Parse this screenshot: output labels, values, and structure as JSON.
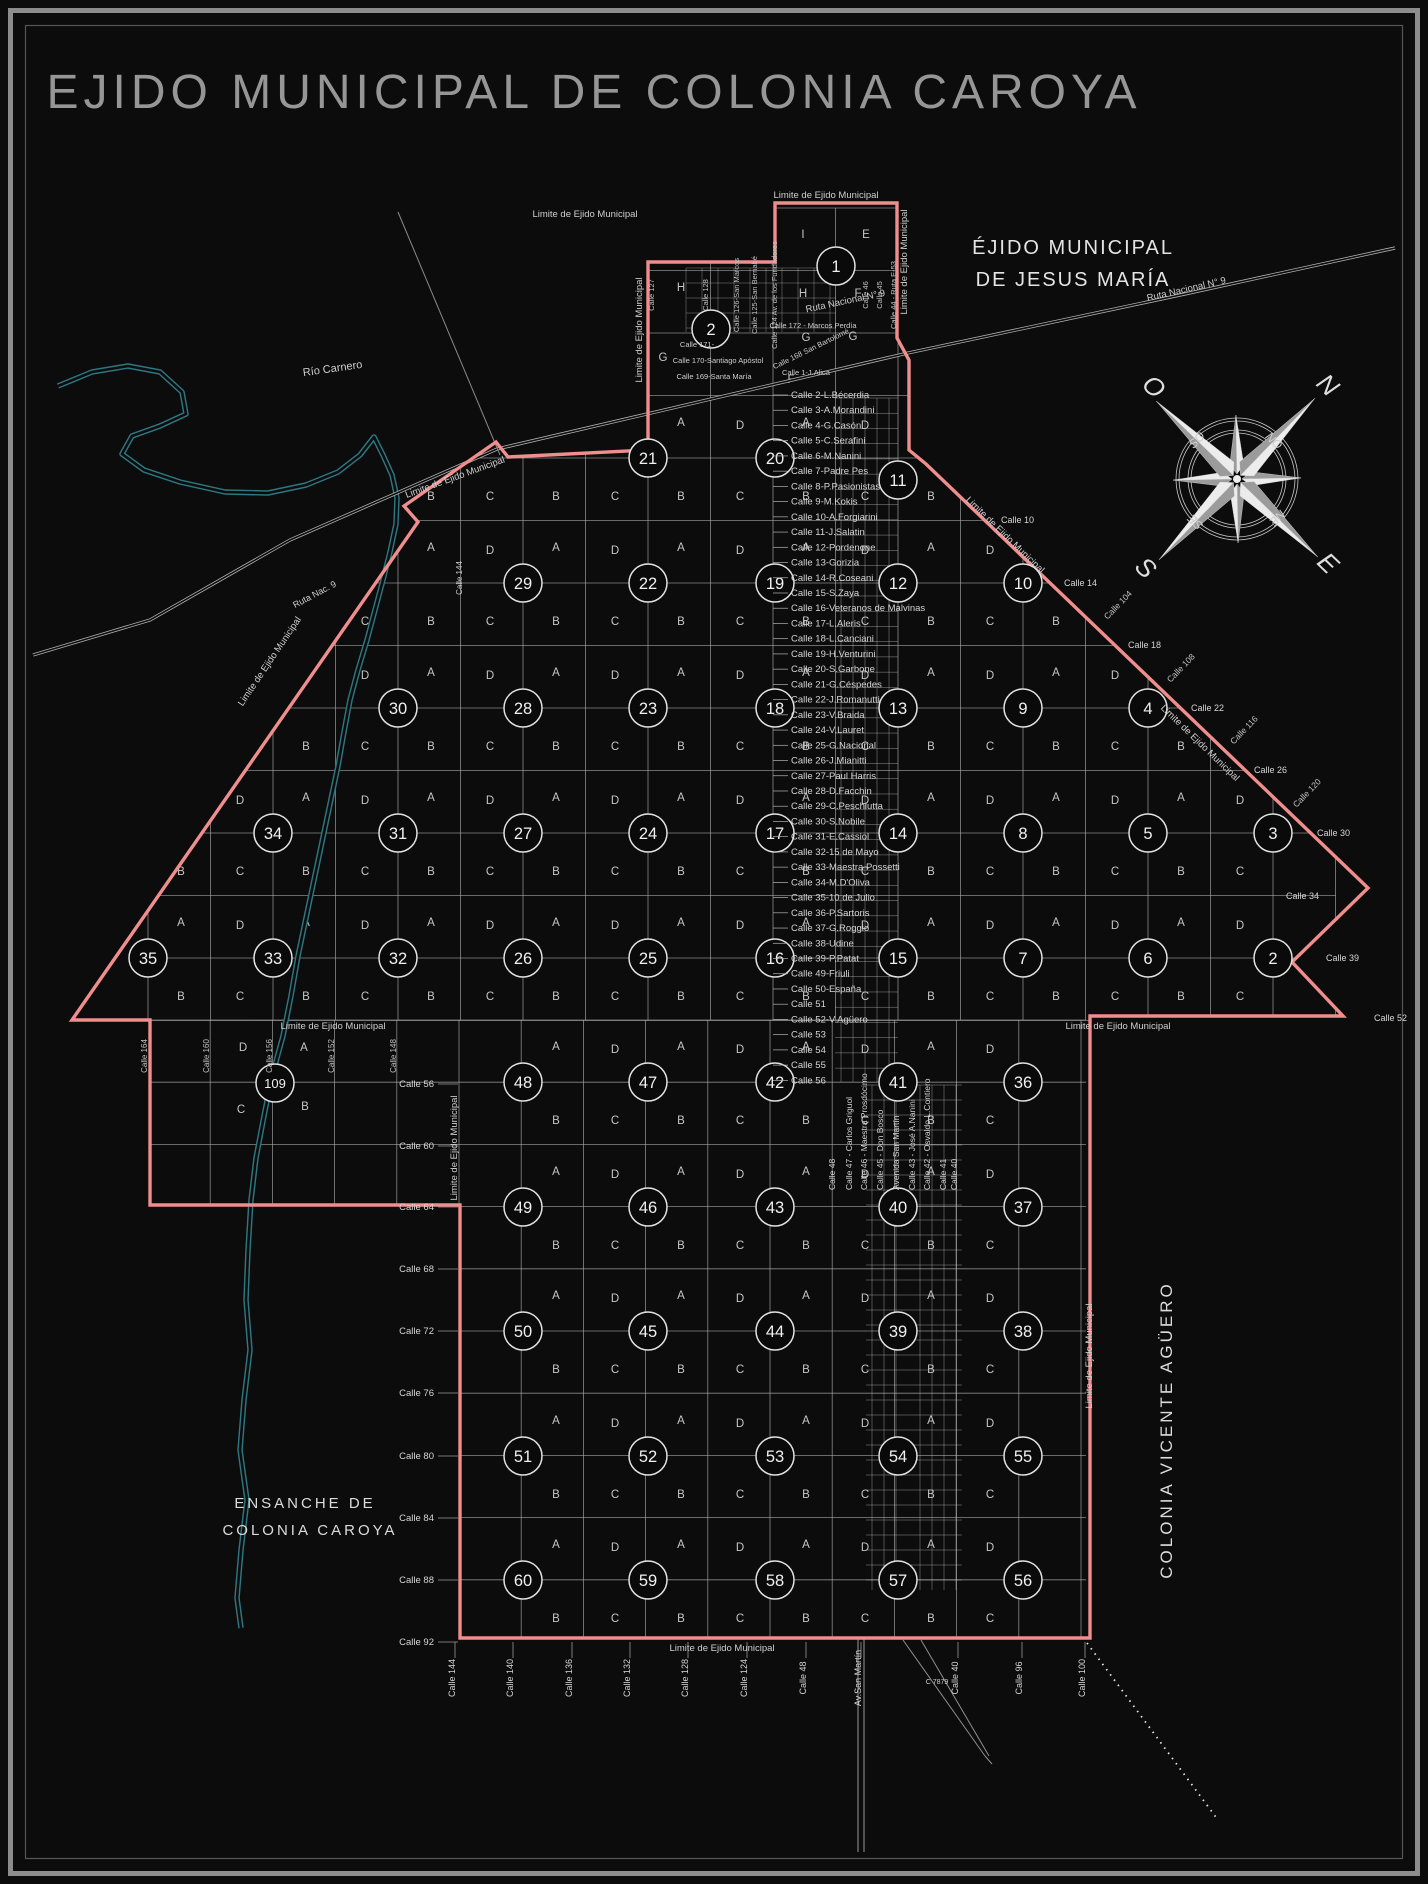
{
  "title": "EJIDO MUNICIPAL DE COLONIA CAROYA",
  "colors": {
    "background": "#0c0c0c",
    "boundary_pink": "#f08d8d",
    "grid_gray": "#a9a9a9",
    "dense_gray": "#c9c9c9",
    "river_teal": "#2e7680",
    "label_light": "#d6d6d6",
    "label_dim": "#9e9e9e",
    "circle_stroke": "#e2e2e2",
    "frame_gray": "#8c8c8c"
  },
  "boundary": {
    "label": "Limite de Ejido Municipal",
    "points": "775,203 897,203 897,338 909,360 909,450 926,464 1368,888 1292,962 1343,1016 1090,1016 1090,1638 460,1638 460,1205 150,1205 150,1020 72,1020 418,522 404,506 496,442 508,457 648,450 648,262 775,262"
  },
  "river": {
    "label": "Río Carnero",
    "points": "58,386 92,372 128,366 160,372 182,392 186,414 160,426 132,436 122,454 144,470 180,482 225,492 268,493 306,485 338,472 360,455 374,437 383,455 392,475 397,498 396,524 390,552 383,580 375,610 367,640 358,670 350,700 344,732 338,766 330,804 322,842 314,880 306,918 298,956 291,996 283,1036 272,1076 264,1116 256,1158 251,1200 248,1250 246,1300 250,1350 244,1400 240,1450 247,1500 241,1550 237,1598 241,1628"
  },
  "roads": {
    "ruta9_points": "33,655 150,620 290,540 497,449 908,353 1185,294 1395,248",
    "crossroad": [
      398,
      212,
      500,
      455
    ],
    "avenue_extension": {
      "x1": 858,
      "x2": 864,
      "y0": 1638,
      "y1": 1852
    },
    "wedge": [
      [
        903,
        1640,
        985,
        1756
      ],
      [
        921,
        1640,
        989,
        1756
      ],
      [
        985,
        1756,
        992,
        1764
      ]
    ],
    "dotted_rail": [
      1087,
      1643,
      1218,
      1820
    ]
  },
  "grid": {
    "upper": {
      "x0": 148,
      "x1": 1336,
      "y0": 208,
      "y1": 1020,
      "step": 62.5
    },
    "lower": {
      "x0": 148,
      "x1": 1086,
      "y0": 1020,
      "y1": 1641,
      "step": 62.2
    },
    "dense_top": {
      "x0": 686,
      "x1": 836,
      "y0": 268,
      "y1": 332,
      "col_step": 16,
      "row_step": 15
    },
    "dense_upper": {
      "cols": [
        841,
        853,
        865,
        877,
        889
      ],
      "x0": 835,
      "x1": 898,
      "y0": 398,
      "y1": 1082,
      "row_step": 15.23
    },
    "dense_lower": {
      "cols": [
        872,
        884,
        896,
        920,
        932,
        944,
        956
      ],
      "x0": 866,
      "x1": 962,
      "y0": 1085,
      "y1": 1590,
      "row_step": 15
    }
  },
  "blocks": {
    "circles": [
      {
        "n": "1",
        "x": 836,
        "y": 266
      },
      {
        "n": "2",
        "x": 711,
        "y": 329
      },
      {
        "n": "11",
        "x": 898,
        "y": 480
      },
      {
        "n": "21",
        "x": 648,
        "y": 458
      },
      {
        "n": "20",
        "x": 775,
        "y": 458
      },
      {
        "n": "29",
        "x": 523,
        "y": 583
      },
      {
        "n": "22",
        "x": 648,
        "y": 583
      },
      {
        "n": "19",
        "x": 775,
        "y": 583
      },
      {
        "n": "12",
        "x": 898,
        "y": 583
      },
      {
        "n": "10",
        "x": 1023,
        "y": 583
      },
      {
        "n": "30",
        "x": 398,
        "y": 708
      },
      {
        "n": "28",
        "x": 523,
        "y": 708
      },
      {
        "n": "23",
        "x": 648,
        "y": 708
      },
      {
        "n": "18",
        "x": 775,
        "y": 708
      },
      {
        "n": "13",
        "x": 898,
        "y": 708
      },
      {
        "n": "9",
        "x": 1023,
        "y": 708
      },
      {
        "n": "4",
        "x": 1148,
        "y": 708
      },
      {
        "n": "34",
        "x": 273,
        "y": 833
      },
      {
        "n": "31",
        "x": 398,
        "y": 833
      },
      {
        "n": "27",
        "x": 523,
        "y": 833
      },
      {
        "n": "24",
        "x": 648,
        "y": 833
      },
      {
        "n": "17",
        "x": 775,
        "y": 833
      },
      {
        "n": "14",
        "x": 898,
        "y": 833
      },
      {
        "n": "8",
        "x": 1023,
        "y": 833
      },
      {
        "n": "5",
        "x": 1148,
        "y": 833
      },
      {
        "n": "3",
        "x": 1273,
        "y": 833
      },
      {
        "n": "35",
        "x": 148,
        "y": 958
      },
      {
        "n": "33",
        "x": 273,
        "y": 958
      },
      {
        "n": "32",
        "x": 398,
        "y": 958
      },
      {
        "n": "26",
        "x": 523,
        "y": 958
      },
      {
        "n": "25",
        "x": 648,
        "y": 958
      },
      {
        "n": "16",
        "x": 775,
        "y": 958
      },
      {
        "n": "15",
        "x": 898,
        "y": 958
      },
      {
        "n": "7",
        "x": 1023,
        "y": 958
      },
      {
        "n": "6",
        "x": 1148,
        "y": 958
      },
      {
        "n": "2",
        "x": 1273,
        "y": 958
      },
      {
        "n": "109",
        "x": 275,
        "y": 1083
      },
      {
        "n": "48",
        "x": 523,
        "y": 1082
      },
      {
        "n": "47",
        "x": 648,
        "y": 1082
      },
      {
        "n": "42",
        "x": 775,
        "y": 1082
      },
      {
        "n": "41",
        "x": 898,
        "y": 1082
      },
      {
        "n": "36",
        "x": 1023,
        "y": 1082
      },
      {
        "n": "49",
        "x": 523,
        "y": 1207
      },
      {
        "n": "46",
        "x": 648,
        "y": 1207
      },
      {
        "n": "43",
        "x": 775,
        "y": 1207
      },
      {
        "n": "40",
        "x": 898,
        "y": 1207
      },
      {
        "n": "37",
        "x": 1023,
        "y": 1207
      },
      {
        "n": "50",
        "x": 523,
        "y": 1331
      },
      {
        "n": "45",
        "x": 648,
        "y": 1331
      },
      {
        "n": "44",
        "x": 775,
        "y": 1331
      },
      {
        "n": "39",
        "x": 898,
        "y": 1331
      },
      {
        "n": "38",
        "x": 1023,
        "y": 1331
      },
      {
        "n": "51",
        "x": 523,
        "y": 1456
      },
      {
        "n": "52",
        "x": 648,
        "y": 1456
      },
      {
        "n": "53",
        "x": 775,
        "y": 1456
      },
      {
        "n": "54",
        "x": 898,
        "y": 1456
      },
      {
        "n": "55",
        "x": 1023,
        "y": 1456
      },
      {
        "n": "60",
        "x": 523,
        "y": 1580
      },
      {
        "n": "59",
        "x": 648,
        "y": 1580
      },
      {
        "n": "58",
        "x": 775,
        "y": 1580
      },
      {
        "n": "57",
        "x": 898,
        "y": 1580
      },
      {
        "n": "56",
        "x": 1023,
        "y": 1580
      }
    ]
  },
  "quadrants": {
    "letters": [
      "A",
      "D",
      "B",
      "C"
    ],
    "upper": {
      "cols": [
        148,
        273,
        398,
        523,
        648,
        773,
        898,
        1023,
        1148,
        1273
      ],
      "rows": [
        458,
        583,
        708,
        833,
        958
      ]
    },
    "lower": {
      "cols": [
        523,
        648,
        773,
        898,
        1023
      ],
      "rows": [
        1082,
        1207,
        1331,
        1456,
        1580
      ]
    },
    "extra": [
      {
        "t": "D",
        "x": 243,
        "y": 1051
      },
      {
        "t": "A",
        "x": 304,
        "y": 1051
      },
      {
        "t": "C",
        "x": 241,
        "y": 1113
      },
      {
        "t": "B",
        "x": 305,
        "y": 1110
      },
      {
        "t": "I",
        "x": 803,
        "y": 238
      },
      {
        "t": "E",
        "x": 866,
        "y": 238
      },
      {
        "t": "H",
        "x": 681,
        "y": 291
      },
      {
        "t": "H",
        "x": 803,
        "y": 297
      },
      {
        "t": "F",
        "x": 858,
        "y": 297
      },
      {
        "t": "F",
        "x": 791,
        "y": 383
      },
      {
        "t": "G",
        "x": 663,
        "y": 361
      },
      {
        "t": "G",
        "x": 806,
        "y": 341
      },
      {
        "t": "G",
        "x": 853,
        "y": 340
      }
    ]
  },
  "center_streets": {
    "x": 791,
    "y_start": 398,
    "spacing": 15.23,
    "items": [
      "Calle 2-L.Bécerdia",
      "Calle 3-A.Morandini",
      "Calle 4-G.Casón",
      "Calle 5-C.Serafini",
      "Calle 6-M.Nanini",
      "Calle 7-Padre Pes",
      "Calle 8-P.Pasionistas",
      "Calle 9-M.Kokis",
      "Calle 10-A.Forgiarini",
      "Calle 11-J.Salatin",
      "Calle 12-Pordenone",
      "Calle 13-Gorizia",
      "Calle 14-R.Coseani",
      "Calle 15-S.Zaya",
      "Calle 16-Veteranos de Malvinas",
      "Calle 17-L.Aleris",
      "Calle 18-L.Canciani",
      "Calle 19-H.Venturini",
      "Calle 20-S.Garbone",
      "Calle 21-G.Céspedes",
      "Calle 22-J.Romanutti",
      "Calle 23-V.Braida",
      "Calle 24-V.Lauret",
      "Calle 25-G.Nacional",
      "Calle 26-J.Mianitti",
      "Calle 27-Paul Harris",
      "Calle 28-D.Facchin",
      "Calle 29-C.Peschiutta",
      "Calle 30-S.Nobile",
      "Calle 31-E.Cassiol",
      "Calle 32-15 de Mayo",
      "Calle 33-Maestra Possetti",
      "Calle 34-M.D'Oliva",
      "Calle 35-10 de Julio",
      "Calle 36-P.Sartoris",
      "Calle 37-G.Roggio",
      "Calle 38-Udine",
      "Calle 39-P.Patat",
      "Calle 49-Friuli",
      "Calle 50-España",
      "Calle 51",
      "Calle 52-V.Agüero",
      "Calle 53",
      "Calle 54",
      "Calle 55",
      "Calle 56"
    ]
  },
  "bottom_center_streets": {
    "y": 1190,
    "items": [
      {
        "x": 835,
        "t": "Calle 48"
      },
      {
        "x": 852,
        "t": "Calle 47 - Carlos Griguol"
      },
      {
        "x": 867,
        "t": "Calle 46 - Maestra Prosdócimo"
      },
      {
        "x": 883,
        "t": "Calle 45 - Don Bosco"
      },
      {
        "x": 899,
        "t": "Avenida San Martín"
      },
      {
        "x": 915,
        "t": "Calle 43 - José A.Nanini"
      },
      {
        "x": 930,
        "t": "Calle 42 - Osvaldo L.Contiero"
      },
      {
        "x": 946,
        "t": "Calle 41"
      },
      {
        "x": 957,
        "t": "Calle 40"
      }
    ]
  },
  "left_margin": {
    "x": 434,
    "items": [
      {
        "y": 1084,
        "t": "Calle 56"
      },
      {
        "y": 1146,
        "t": "Calle 60"
      },
      {
        "y": 1207,
        "t": "Calle 64"
      },
      {
        "y": 1269,
        "t": "Calle 68"
      },
      {
        "y": 1331,
        "t": "Calle 72"
      },
      {
        "y": 1393,
        "t": "Calle 76"
      },
      {
        "y": 1456,
        "t": "Calle 80"
      },
      {
        "y": 1518,
        "t": "Calle 84"
      },
      {
        "y": 1580,
        "t": "Calle 88"
      },
      {
        "y": 1642,
        "t": "Calle 92"
      }
    ]
  },
  "bottom_streets": {
    "y": 1678,
    "items": [
      {
        "x": 455,
        "t": "Calle 144"
      },
      {
        "x": 513,
        "t": "Calle 140"
      },
      {
        "x": 572,
        "t": "Calle 136"
      },
      {
        "x": 630,
        "t": "Calle 132"
      },
      {
        "x": 688,
        "t": "Calle 128"
      },
      {
        "x": 747,
        "t": "Calle 124"
      },
      {
        "x": 806,
        "t": "Calle 48"
      },
      {
        "x": 861,
        "t": "Av.San Martín"
      },
      {
        "x": 958,
        "t": "Calle 40"
      },
      {
        "x": 1022,
        "t": "Calle 96"
      },
      {
        "x": 1085,
        "t": "Calle 100"
      }
    ]
  },
  "left_extension_streets": {
    "y": 1056,
    "items": [
      {
        "x": 147,
        "t": "Calle 164"
      },
      {
        "x": 209,
        "t": "Calle 160"
      },
      {
        "x": 272,
        "t": "Calle 156"
      },
      {
        "x": 334,
        "t": "Calle 152"
      },
      {
        "x": 396,
        "t": "Calle 148"
      }
    ]
  },
  "right_edge_labels": {
    "horizontal": [
      {
        "x": 1001,
        "y": 523,
        "t": "Calle 10"
      },
      {
        "x": 1064,
        "y": 586,
        "t": "Calle 14"
      },
      {
        "x": 1128,
        "y": 648,
        "t": "Calle 18"
      },
      {
        "x": 1191,
        "y": 711,
        "t": "Calle 22"
      },
      {
        "x": 1254,
        "y": 773,
        "t": "Calle 26"
      },
      {
        "x": 1317,
        "y": 836,
        "t": "Calle 30"
      },
      {
        "x": 1286,
        "y": 899,
        "t": "Calle 34"
      },
      {
        "x": 1326,
        "y": 961,
        "t": "Calle 39"
      },
      {
        "x": 1374,
        "y": 1021,
        "t": "Calle 52"
      }
    ],
    "rotated": [
      {
        "x": 1120,
        "y": 607,
        "t": "Calle 104"
      },
      {
        "x": 1183,
        "y": 670,
        "t": "Calle 108"
      },
      {
        "x": 1246,
        "y": 732,
        "t": "Calle 116"
      },
      {
        "x": 1309,
        "y": 795,
        "t": "Calle 120"
      }
    ]
  },
  "top_vertical_streets": {
    "y": 295,
    "items": [
      {
        "x": 654,
        "t": "Calle 127"
      },
      {
        "x": 708,
        "t": "Calle 128"
      },
      {
        "x": 739,
        "t": "Calle 126-San Marcos"
      },
      {
        "x": 757,
        "t": "Calle 125-San Bernabé"
      },
      {
        "x": 777,
        "t": "Calle 124 Av. de los Fundadores"
      },
      {
        "x": 868,
        "t": "Calle 46"
      },
      {
        "x": 882,
        "t": "Calle 45"
      },
      {
        "x": 896,
        "t": "Calle 44 - Ruta E-53"
      }
    ]
  },
  "misc_labels": [
    {
      "t": "Limite de Ejido Municipal",
      "x": 826,
      "y": 198
    },
    {
      "t": "Limite de Ejido Municipal",
      "x": 585,
      "y": 217
    },
    {
      "t": "Limite de Ejido Municipal",
      "x": 907,
      "y": 262,
      "r": -90
    },
    {
      "t": "Limite de Ejido Municipal",
      "x": 642,
      "y": 330,
      "r": -90
    },
    {
      "t": "Limite de Ejido Municipal",
      "x": 456,
      "y": 480,
      "r": -20
    },
    {
      "t": "Limite de Ejido Municipal",
      "x": 272,
      "y": 663,
      "r": -56
    },
    {
      "t": "Limite de Ejido Municipal",
      "x": 1003,
      "y": 537,
      "r": 44
    },
    {
      "t": "Limite de Ejido Municipal",
      "x": 1198,
      "y": 745,
      "r": 44
    },
    {
      "t": "Limite de Ejido Municipal",
      "x": 333,
      "y": 1029
    },
    {
      "t": "Limite de Ejido Municipal",
      "x": 1118,
      "y": 1029
    },
    {
      "t": "Limite de Ejido Municipal",
      "x": 722,
      "y": 1651
    },
    {
      "t": "Limite de Ejido Municipal",
      "x": 1092,
      "y": 1356,
      "r": -90
    },
    {
      "t": "Limite de Ejido Municipal",
      "x": 457,
      "y": 1148,
      "r": -90
    },
    {
      "t": "Río Carnero",
      "x": 333,
      "y": 372,
      "r": -8,
      "s": 11
    },
    {
      "t": "Ruta Nacional N° 9",
      "x": 846,
      "y": 304,
      "r": -12
    },
    {
      "t": "Ruta Nacional N° 9",
      "x": 1187,
      "y": 292,
      "r": -13
    },
    {
      "t": "Ruta Nac. 9",
      "x": 316,
      "y": 597,
      "r": -28,
      "s": 9
    },
    {
      "t": "Calle 168 San Bartolomé",
      "x": 812,
      "y": 351,
      "r": -26,
      "s": 7.5
    },
    {
      "t": "Calle 172 - Marcos Perdía",
      "x": 813,
      "y": 328,
      "s": 7.5
    },
    {
      "t": "Calle 171-",
      "x": 697,
      "y": 347,
      "s": 7.5
    },
    {
      "t": "Calle 170-Santiago Apóstol",
      "x": 718,
      "y": 363,
      "s": 7.5
    },
    {
      "t": "Calle 169-Santa María",
      "x": 714,
      "y": 379,
      "s": 7.5
    },
    {
      "t": "Calle 1-J.Alica",
      "x": 806,
      "y": 375,
      "s": 7.5
    },
    {
      "t": "Calle 144",
      "x": 462,
      "y": 578,
      "r": -90,
      "s": 8
    },
    {
      "t": "C 7879",
      "x": 937,
      "y": 1684,
      "s": 7
    }
  ],
  "big_labels": [
    {
      "t": "ÉJIDO MUNICIPAL",
      "x": 1073,
      "y": 254,
      "s": 20,
      "ls": 2,
      "c": "#e4e4e4"
    },
    {
      "t": "DE JESUS MARÍA",
      "x": 1073,
      "y": 286,
      "s": 20,
      "ls": 2,
      "c": "#e4e4e4"
    },
    {
      "t": "COLONIA VICENTE AGÜERO",
      "x": 1172,
      "y": 1430,
      "r": -90,
      "s": 17,
      "ls": 3,
      "c": "#dcdcdc"
    },
    {
      "t": "ENSANCHE DE",
      "x": 305,
      "y": 1508,
      "s": 15,
      "ls": 3,
      "c": "#dcdcdc"
    },
    {
      "t": "COLONIA CAROYA",
      "x": 310,
      "y": 1535,
      "s": 15,
      "ls": 3,
      "c": "#dcdcdc"
    }
  ],
  "compass": {
    "cx": 1237,
    "cy": 479,
    "rotation": 44,
    "rings": [
      46,
      49,
      58,
      61
    ],
    "long_point": 112,
    "short_point": 64,
    "cardinals": [
      {
        "t": "N",
        "x": 0,
        "y": -122
      },
      {
        "t": "E",
        "x": 124,
        "y": 6
      },
      {
        "t": "S",
        "x": -4,
        "y": 136
      },
      {
        "t": "O",
        "x": -124,
        "y": 0
      }
    ],
    "intercardinals": [
      {
        "t": "NO",
        "x": 0,
        "y": -49,
        "r": 0
      },
      {
        "t": "NE",
        "x": 52,
        "y": 0,
        "r": 90
      },
      {
        "t": "SE",
        "x": 0,
        "y": 56,
        "r": 180
      },
      {
        "t": "SO",
        "x": -52,
        "y": 0,
        "r": 270
      }
    ]
  }
}
